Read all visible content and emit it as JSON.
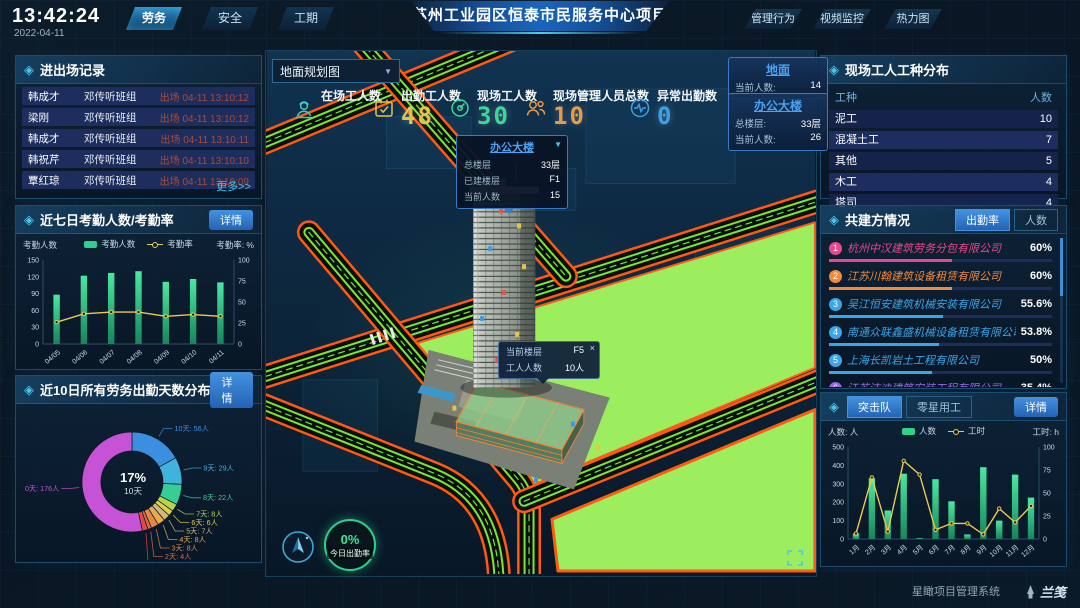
{
  "icons": {
    "diamond": "◈",
    "caret_down": "▼",
    "dropdown_caret": "▼"
  },
  "header": {
    "time": "13:42:24",
    "date": "2022-04-11",
    "title": "苏州工业园区恒泰市民服务中心项目",
    "nav_left": [
      {
        "label": "劳务",
        "active": true
      },
      {
        "label": "安全",
        "active": false
      },
      {
        "label": "工期",
        "active": false
      }
    ],
    "nav_right": [
      {
        "label": "管理行为"
      },
      {
        "label": "视频监控"
      },
      {
        "label": "热力图"
      }
    ]
  },
  "left": {
    "entry_exit": {
      "title": "进出场记录",
      "more": "更多>>",
      "rows": [
        {
          "name": "韩成才",
          "team": "邓传听班组",
          "event": "出场 04-11 13:10:12"
        },
        {
          "name": "梁刚",
          "team": "邓传听班组",
          "event": "出场 04-11 13:10:12"
        },
        {
          "name": "韩成才",
          "team": "邓传听班组",
          "event": "出场 04-11 13:10:11"
        },
        {
          "name": "韩祝芹",
          "team": "邓传听班组",
          "event": "出场 04-11 13:10:10"
        },
        {
          "name": "覃红琼",
          "team": "邓传听班组",
          "event": "出场 04-11 13:10:09"
        }
      ]
    },
    "attendance": {
      "title": "近七日考勤人数/考勤率",
      "detail": "详情"
    },
    "distribution": {
      "title": "近10日所有劳务出勤天数分布",
      "detail": "详情"
    }
  },
  "center": {
    "view_select": {
      "value": "地面规划图"
    },
    "stats": [
      {
        "label": "在场工人数",
        "value": "",
        "color": "#3ecfc0"
      },
      {
        "label": "出勤工人数",
        "value": "48",
        "color": "#e3c44a"
      },
      {
        "label": "现场工人数",
        "value": "30",
        "color": "#3ad89a"
      },
      {
        "label": "现场管理人员总数",
        "value": "10",
        "color": "#e89a4a"
      },
      {
        "label": "异常出勤数",
        "value": "0",
        "color": "#3aa0e8"
      }
    ],
    "ground_card": {
      "title": "地面",
      "rows": [
        {
          "label": "当前人数:",
          "value": "14"
        }
      ]
    },
    "building_card": {
      "title": "办公大楼",
      "rows": [
        {
          "label": "总楼层:",
          "value": "33层"
        },
        {
          "label": "当前人数:",
          "value": "26"
        }
      ]
    },
    "building_tooltip": {
      "title": "办公大楼",
      "rows": [
        {
          "label": "总楼层",
          "value": "33层"
        },
        {
          "label": "已建楼层",
          "value": "F1"
        },
        {
          "label": "当前人数",
          "value": "15"
        }
      ]
    },
    "floor_tooltip": {
      "close": "×",
      "rows": [
        {
          "label": "当前楼层",
          "value": "F5"
        },
        {
          "label": "工人人数",
          "value": "10人"
        }
      ]
    },
    "today_rate": {
      "value": "0%",
      "label": "今日出勤率"
    }
  },
  "right": {
    "trades": {
      "title": "现场工人工种分布",
      "headers": [
        "工种",
        "人数"
      ],
      "rows": [
        [
          "泥工",
          "10"
        ],
        [
          "混凝土工",
          "7"
        ],
        [
          "其他",
          "5"
        ],
        [
          "木工",
          "4"
        ],
        [
          "塔司",
          "4"
        ]
      ]
    },
    "partners": {
      "title": "共建方情况",
      "tabs": [
        {
          "label": "出勤率",
          "active": true
        },
        {
          "label": "人数",
          "active": false
        }
      ],
      "items": [
        {
          "rank": "1",
          "name": "杭州中汉建筑劳务分包有限公司",
          "value": "60%",
          "pct": 60,
          "color": "#e8478d"
        },
        {
          "rank": "2",
          "name": "江苏川翰建筑设备租赁有限公司",
          "value": "60%",
          "pct": 60,
          "color": "#f08a3c"
        },
        {
          "rank": "3",
          "name": "吴江恒安建筑机械安装有限公司",
          "value": "55.6%",
          "pct": 55.6,
          "color": "#38a6e8"
        },
        {
          "rank": "4",
          "name": "南通众联鑫盛机械设备租赁有限公司",
          "value": "53.8%",
          "pct": 53.8,
          "color": "#38a6e8"
        },
        {
          "rank": "5",
          "name": "上海长凯岩土工程有限公司",
          "value": "50%",
          "pct": 50,
          "color": "#38a6e8"
        },
        {
          "rank": "6",
          "name": "江苏洁迪建筑安装工程有限公司",
          "value": "35.4%",
          "pct": 35.4,
          "color": "#9a6ae8"
        }
      ]
    },
    "teams": {
      "tabs": [
        {
          "label": "突击队",
          "active": true
        },
        {
          "label": "零星用工",
          "active": false
        }
      ],
      "detail": "详情"
    }
  },
  "footer": {
    "system": "星瞰项目管理系统",
    "logo": "兰笺"
  },
  "chart_data": [
    {
      "id": "attendance",
      "type": "bar",
      "title": "近七日考勤人数/考勤率",
      "categories": [
        "04/05",
        "04/06",
        "04/07",
        "04/08",
        "04/09",
        "04/10",
        "04/11"
      ],
      "series": [
        {
          "name": "考勤人数",
          "type": "bar",
          "axis": "left",
          "values": [
            88,
            122,
            127,
            130,
            111,
            116,
            110
          ]
        },
        {
          "name": "考勤率",
          "type": "line",
          "axis": "right",
          "values": [
            26,
            36,
            38,
            38,
            33,
            35,
            33
          ]
        }
      ],
      "y_left": {
        "label": "考勤人数",
        "min": 0,
        "max": 150,
        "step": 30
      },
      "y_right": {
        "label": "考勤率: %",
        "min": 0,
        "max": 100,
        "step": 25
      },
      "legend_position": "top",
      "grid": false
    },
    {
      "id": "attendance-days",
      "type": "pie",
      "title": "近10日所有劳务出勤天数分布",
      "center": {
        "value": "17%",
        "label": "10天"
      },
      "slices": [
        {
          "label": "10天",
          "count": 56,
          "color": "#3c8fe0"
        },
        {
          "label": "9天",
          "count": 29,
          "color": "#3fb3dc"
        },
        {
          "label": "8天",
          "count": 22,
          "color": "#35cf96"
        },
        {
          "label": "7天",
          "count": 8,
          "color": "#b8d44e"
        },
        {
          "label": "6天",
          "count": 6,
          "color": "#e0cf4a"
        },
        {
          "label": "5天",
          "count": 7,
          "color": "#cdb97a"
        },
        {
          "label": "4天",
          "count": 8,
          "color": "#e8aa4e"
        },
        {
          "label": "3天",
          "count": 8,
          "color": "#e08a46"
        },
        {
          "label": "2天",
          "count": 4,
          "color": "#e06a46"
        },
        {
          "label": "1天",
          "count": 6,
          "color": "#e04a46"
        },
        {
          "label": "0天",
          "count": 176,
          "color": "#c653d6"
        }
      ]
    },
    {
      "id": "assault-team",
      "type": "bar",
      "title": "突击队",
      "categories": [
        "1月",
        "2月",
        "3月",
        "4月",
        "5月",
        "6月",
        "7月",
        "8月",
        "9月",
        "10月",
        "11月",
        "12月"
      ],
      "series": [
        {
          "name": "人数",
          "type": "bar",
          "axis": "left",
          "values": [
            30,
            330,
            155,
            355,
            5,
            325,
            205,
            25,
            390,
            100,
            350,
            225
          ]
        },
        {
          "name": "工时",
          "type": "line",
          "axis": "right",
          "values": [
            6,
            67,
            8,
            85,
            70,
            10,
            17,
            17,
            5,
            33,
            18,
            36
          ]
        }
      ],
      "y_left": {
        "label": "人数: 人",
        "min": 0,
        "max": 500,
        "step": 100
      },
      "y_right": {
        "label": "工时: h",
        "min": 0,
        "max": 100,
        "step": 25
      },
      "legend_position": "top",
      "grid": false
    }
  ]
}
